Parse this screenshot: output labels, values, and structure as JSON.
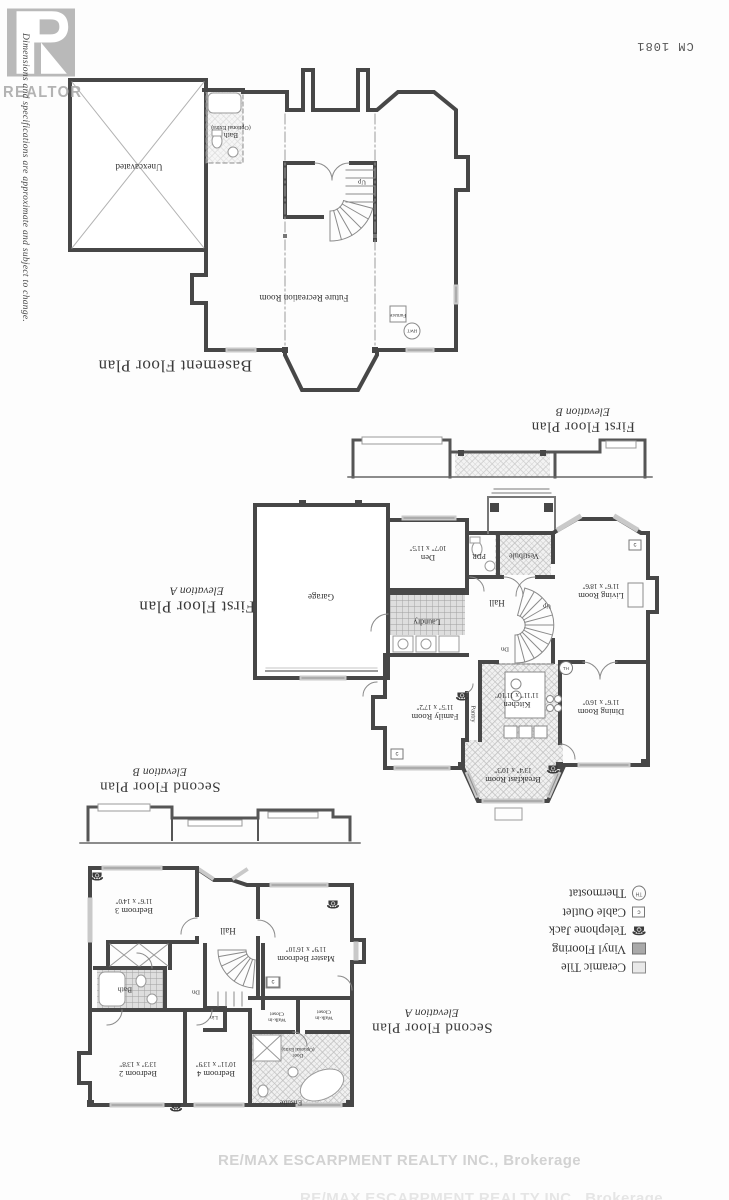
{
  "meta": {
    "plan_code": "CM 1081",
    "disclaimer": "Dimensions and specifications are approximate and subject to change.",
    "realtor_logo_text": "REALTOR",
    "brokerage_watermark": "RE/MAX ESCARPMENT REALTY INC., Brokerage"
  },
  "symbols": {
    "phone_glyph": "☎",
    "cable_letter": "c",
    "thermostat_letters": "TH"
  },
  "basement": {
    "title": "Basement Floor Plan",
    "labels": {
      "unexcavated": "Unexcavated",
      "bath": "Bath",
      "bath_note": "(Optional Extra)",
      "up": "Up",
      "future_rec": "Future Recreation Room",
      "furnace": "Furnace",
      "hwt": "HWT"
    }
  },
  "first_floor": {
    "title": "First Floor Plan",
    "elevation_a": "Elevation A",
    "elevation_b": "Elevation B",
    "stairs": {
      "up": "Up",
      "dn": "Dn"
    },
    "rooms": {
      "garage": {
        "name": "Garage"
      },
      "den": {
        "name": "Den",
        "dims": "10'7\" x 11'5\""
      },
      "pdr": {
        "name": "PDR"
      },
      "vestibule": {
        "name": "Vestibule"
      },
      "hall": {
        "name": "Hall"
      },
      "living": {
        "name": "Living Room",
        "dims": "11'6\" x 18'6\""
      },
      "laundry": {
        "name": "Laundry"
      },
      "family": {
        "name": "Family Room",
        "dims": "11'5\" x 17'2\""
      },
      "pantry": {
        "name": "Pantry"
      },
      "kitchen": {
        "name": "Kitchen",
        "dims": "11'11\" x 11'10\""
      },
      "dining": {
        "name": "Dining Room",
        "dims": "11'6\" x 16'0\""
      },
      "breakfast": {
        "name": "Breakfast Room",
        "dims": "13'4\" x 10'3\""
      }
    }
  },
  "second_floor": {
    "title": "Second Floor Plan",
    "elevation_a": "Elevation A",
    "elevation_b": "Elevation B",
    "stairs": {
      "dn": "Dn"
    },
    "rooms": {
      "bedroom3": {
        "name": "Bedroom 3",
        "dims": "11'6\" x 14'0\""
      },
      "hall": {
        "name": "Hall"
      },
      "master": {
        "name": "Master Bedroom",
        "dims": "11'9\" x 16'10\""
      },
      "bath": {
        "name": "Bath"
      },
      "lin": {
        "name": "Lin"
      },
      "wic_l1": "Walk-in",
      "wic_l2": "Closet",
      "bedroom2": {
        "name": "Bedroom 2",
        "dims": "13'3\" x 13'8\""
      },
      "bedroom4": {
        "name": "Bedroom 4",
        "dims": "10'11\" x 13'9\""
      },
      "ensuite": {
        "name": "Ensuite"
      },
      "door_note_l1": "Door",
      "door_note_l2": "(Optional Extra)"
    }
  },
  "legend": {
    "items": [
      {
        "label": "Ceramic Tile"
      },
      {
        "label": "Vinyl Flooring"
      },
      {
        "label": "Telephone Jack"
      },
      {
        "label": "Cable Outlet"
      },
      {
        "label": "Thermostat"
      }
    ]
  }
}
